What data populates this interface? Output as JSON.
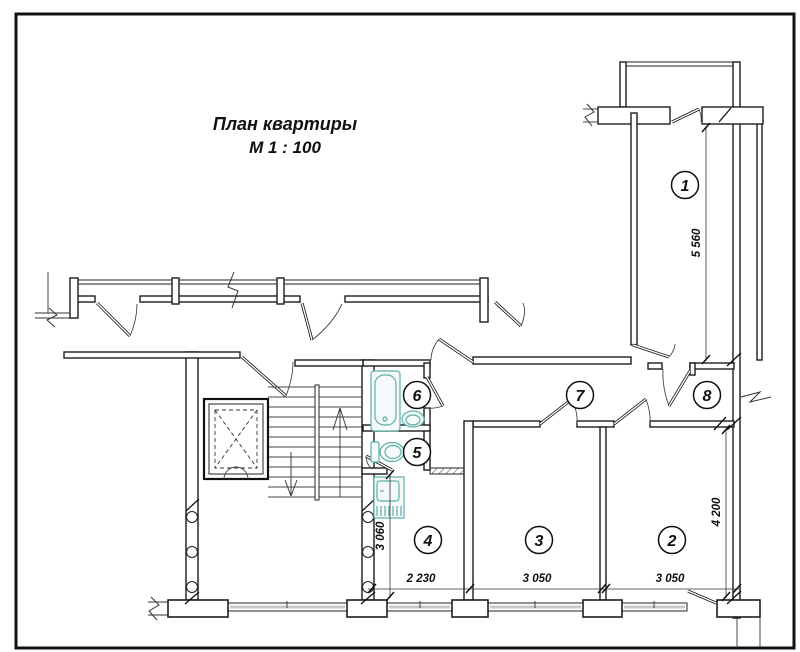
{
  "title": {
    "line1": "План квартиры",
    "line2": "М 1 : 100"
  },
  "rooms": [
    {
      "id": "room-1",
      "number": "1"
    },
    {
      "id": "room-2",
      "number": "2"
    },
    {
      "id": "room-3",
      "number": "3"
    },
    {
      "id": "room-4",
      "number": "4"
    },
    {
      "id": "room-5",
      "number": "5"
    },
    {
      "id": "room-6",
      "number": "6"
    },
    {
      "id": "room-7",
      "number": "7"
    },
    {
      "id": "room-8",
      "number": "8"
    }
  ],
  "dimensions": {
    "room1_depth": "5 560",
    "room2_depth": "4 200",
    "kitchen_depth": "3 060",
    "kitchen_width": "2 230",
    "room3_width": "3 050",
    "room2_width": "3 050"
  },
  "colors": {
    "wall": "#1d1d1d",
    "fixture": "#5fafa6",
    "fixture_fill": "#f3faf9",
    "window": "#c9c9c9"
  }
}
